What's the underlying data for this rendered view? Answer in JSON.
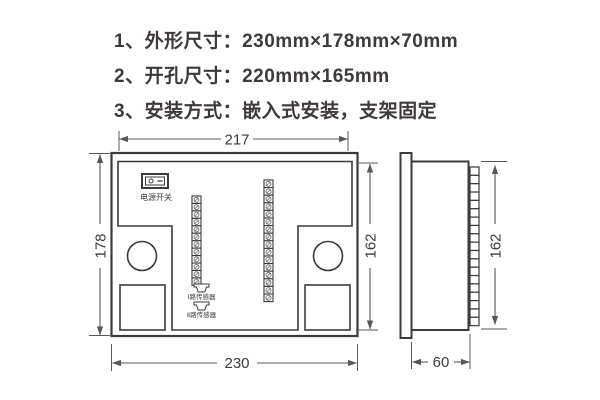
{
  "specs": {
    "lines": [
      "1、外形尺寸：230mm×178mm×70mm",
      "2、开孔尺寸：220mm×165mm",
      "3、安装方式：嵌入式安装，支架固定"
    ]
  },
  "front_view": {
    "dim_top": "217",
    "dim_left": "178",
    "dim_right": "162",
    "dim_bottom": "230",
    "power_switch_label": "电源开关",
    "sensor_channel_1_label": "Ⅰ路传感器",
    "sensor_channel_2_label": "Ⅱ路传感器",
    "terminals_left": 12,
    "terminals_right": 16
  },
  "side_view": {
    "dim_height": "162",
    "dim_depth": "60",
    "terminals": 19
  },
  "colors": {
    "outline": "#3e3a39",
    "dimension_line": "#595757",
    "text": "#3e3a39",
    "background": "#ffffff"
  }
}
